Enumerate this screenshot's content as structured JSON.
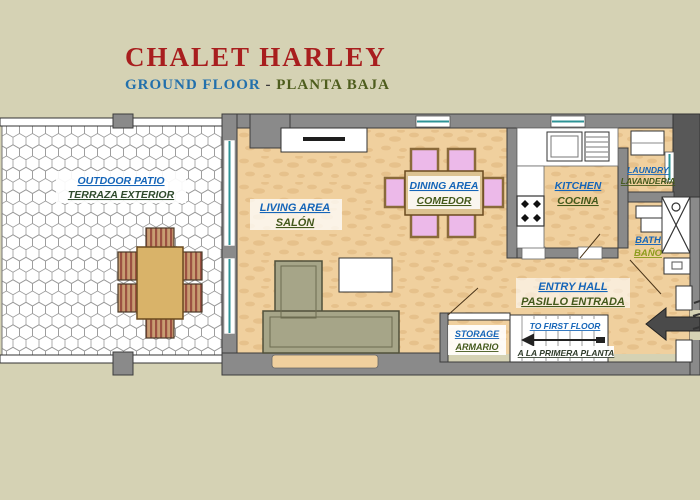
{
  "title": {
    "main": "CHALET HARLEY",
    "subtitle_en": "GROUND FLOOR",
    "subtitle_sep": " - ",
    "subtitle_es": "PLANTA BAJA"
  },
  "rooms": {
    "patio": {
      "en": "OUTDOOR PATIO",
      "es": "TERRAZA EXTERIOR"
    },
    "living": {
      "en": "LIVING AREA",
      "es": "SALÓN"
    },
    "dining": {
      "en": "DINING AREA",
      "es": "COMEDOR"
    },
    "kitchen": {
      "en": "KITCHEN",
      "es": "COCINA"
    },
    "laundry": {
      "en": "LAUNDRY",
      "es": "LAVANDERIA"
    },
    "bath": {
      "en": "BATH",
      "es": "BAÑO"
    },
    "entry": {
      "en": "ENTRY HALL",
      "es": "PASILLO ENTRADA"
    },
    "storage": {
      "en": "STORAGE",
      "es": "ARMARIO"
    },
    "stairs": {
      "en": "TO FIRST FLOOR",
      "es": "A LA PRIMERA PLANTA"
    }
  },
  "icons": [
    "patio-dining-table",
    "patio-chair",
    "sofa",
    "coffee-table",
    "fireplace",
    "dining-table",
    "dining-chair",
    "stove",
    "kitchen-sink",
    "dish-rack",
    "washing-machine",
    "toilet",
    "shower",
    "bath-sink",
    "staircase",
    "stairs-direction-arrow",
    "entrance-arrow",
    "door-swing",
    "window"
  ],
  "colors": {
    "background": "#d5d2b4",
    "title_red": "#a81e1e",
    "label_blue": "#1565b8",
    "label_olive": "#44591c",
    "wall_gray": "#8a8a8a",
    "dark_block": "#585858",
    "floor_tan": "#f0d09e",
    "patio_white": "#ffffff",
    "window_teal": "#2e9396",
    "sofa_green": "#a6a588",
    "dining_chair_pink": "#ecb9e9",
    "table_wood": "#d9b369"
  }
}
